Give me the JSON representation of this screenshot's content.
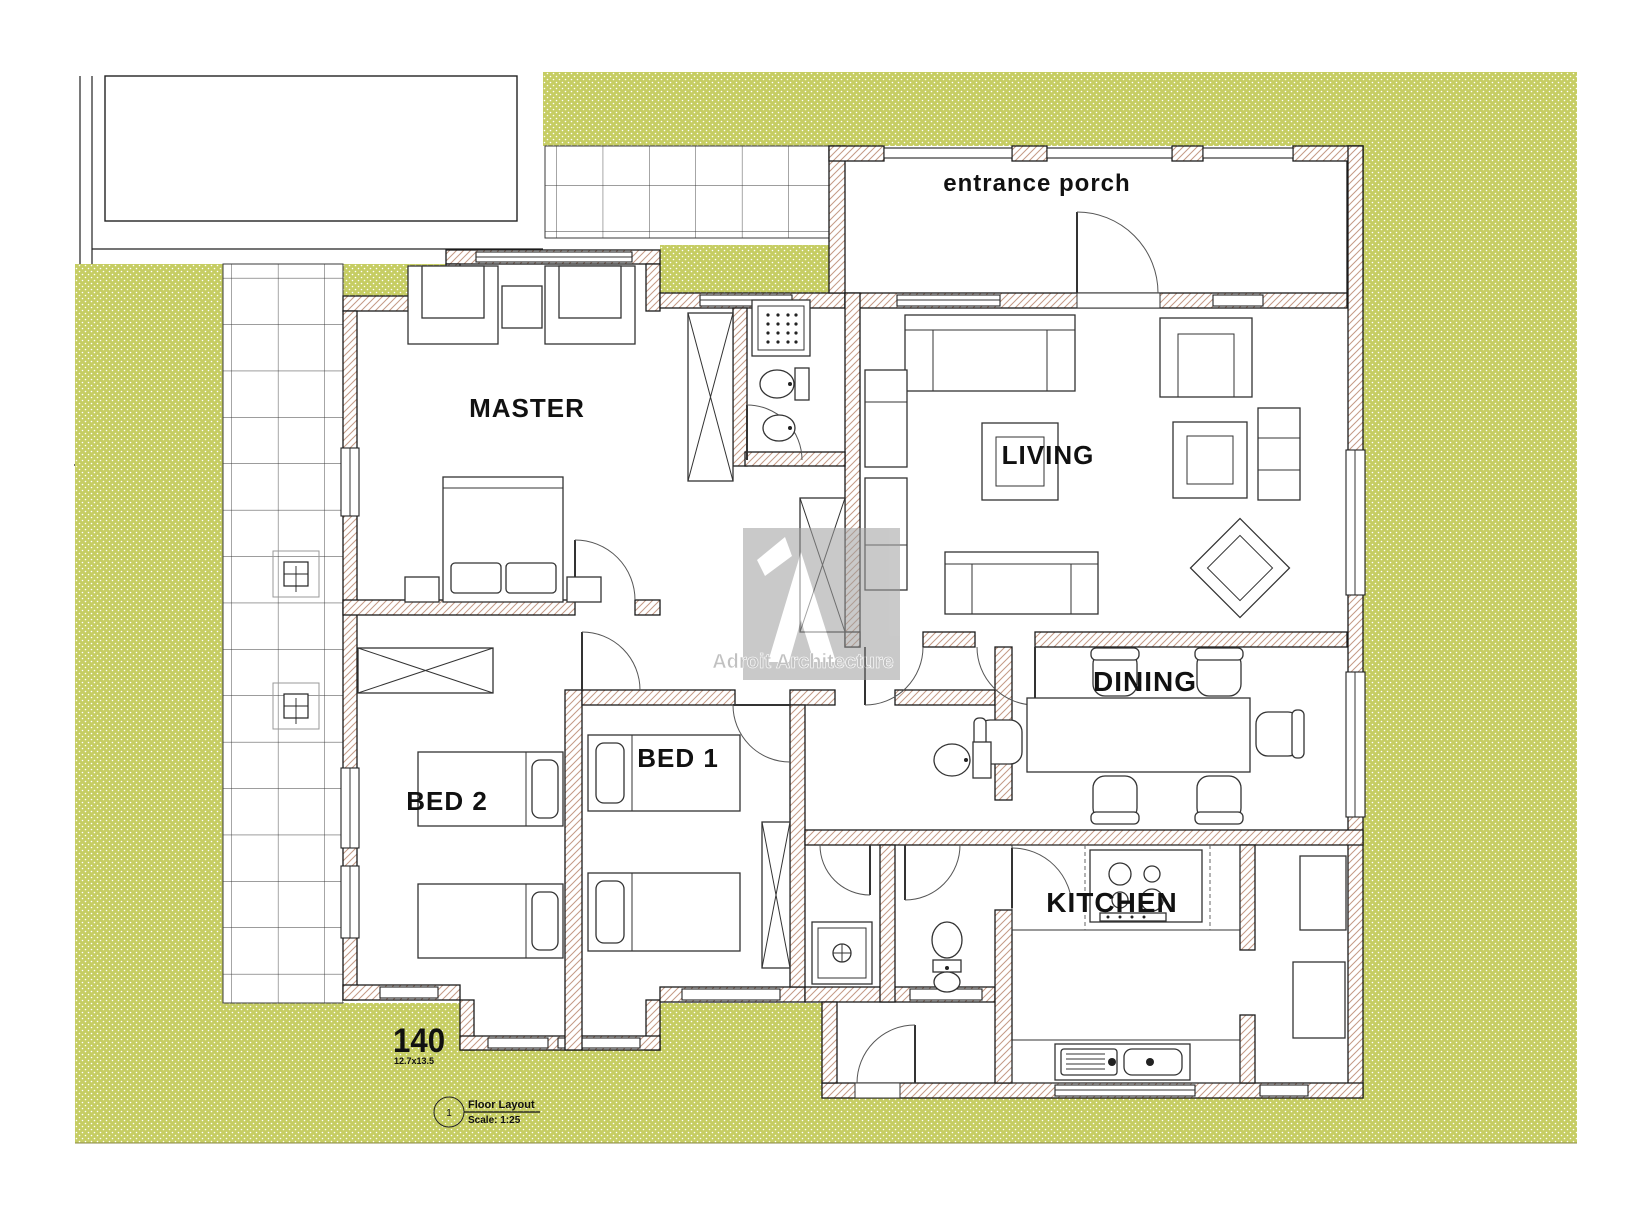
{
  "document": {
    "type": "architectural-floor-plan",
    "sheet_title": "Floor Layout",
    "sheet_scale": "Scale: 1:25",
    "sheet_number": "1"
  },
  "rooms": {
    "master": "MASTER",
    "living": "LIVING",
    "dining": "DINING",
    "kitchen": "KITCHEN",
    "bed1": "BED 1",
    "bed2": "BED 2",
    "porch": "entrance porch"
  },
  "annotations": {
    "area_value": "140",
    "area_dimensions": "12.7x13.5"
  },
  "watermark": {
    "text": "Adroit Architecture"
  },
  "colors": {
    "lawn_green": "#c6cd63",
    "wall_hatch": "#c49a85",
    "ink": "#1a1a1a",
    "watermark_gray": "#bdbdbd"
  }
}
